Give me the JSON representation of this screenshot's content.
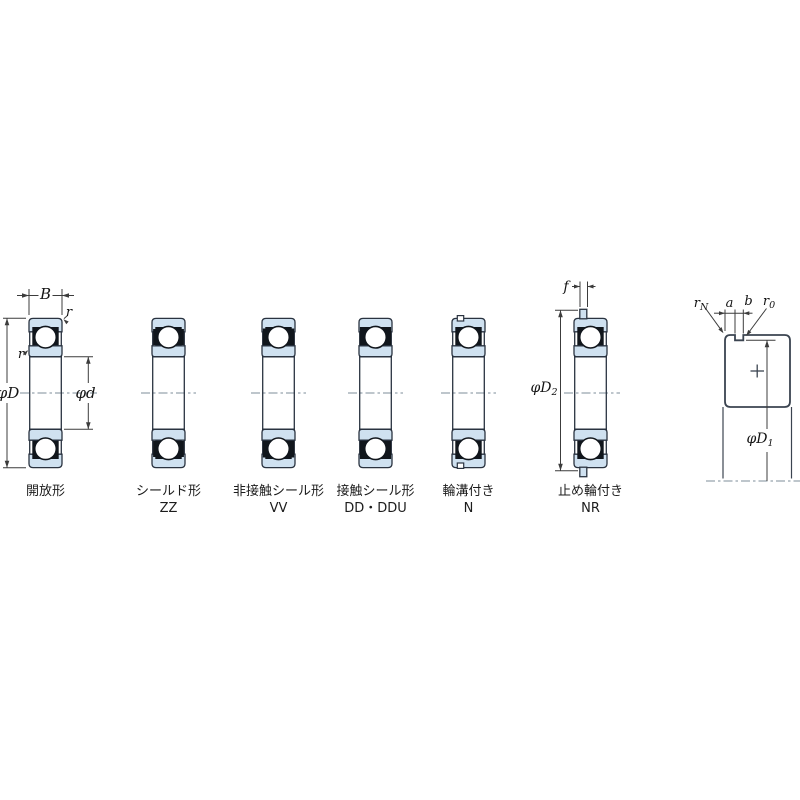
{
  "diagram_title": "deep-groove-ball-bearing-type-chart",
  "colors": {
    "ring_fill": "#cfe1f0",
    "outline": "#2a3340",
    "race_dark": "#11161c",
    "dim_line": "#3c3c3c",
    "centerline": "#7d8c9a",
    "background": "#ffffff",
    "text": "#141414"
  },
  "bearings": [
    {
      "id": "open",
      "label": "開放形",
      "code": "",
      "seal": "open",
      "x": 29,
      "center": 45.5
    },
    {
      "id": "zz",
      "label": "シールド形",
      "code": "ZZ",
      "seal": "shield",
      "x": 152,
      "center": 168.5
    },
    {
      "id": "vv",
      "label": "非接触シール形",
      "code": "VV",
      "seal": "noncontact",
      "x": 262,
      "center": 278.5
    },
    {
      "id": "dd",
      "label": "接触シール形",
      "code": "DD・DDU",
      "seal": "contact",
      "x": 359,
      "center": 375.5
    },
    {
      "id": "n",
      "label": "輪溝付き",
      "code": "N",
      "seal": "open",
      "groove": true,
      "x": 452,
      "center": 468.5
    },
    {
      "id": "nr",
      "label": "止め輪付き",
      "code": "NR",
      "seal": "open",
      "snapring": true,
      "x": 574,
      "center": 590.5
    }
  ],
  "dims": {
    "B": "B",
    "r_top": "r",
    "r_left": "r",
    "phi_D": "φD",
    "phi_d": "φd",
    "f": "f",
    "phi_D2": {
      "text": "φD",
      "sub": "2"
    },
    "phi_D1": {
      "text": "φD",
      "sub": "1"
    },
    "a": "a",
    "b": "b",
    "r_N": {
      "text": "r",
      "sub": "N"
    },
    "r_0": {
      "text": "r",
      "sub": "0"
    }
  }
}
